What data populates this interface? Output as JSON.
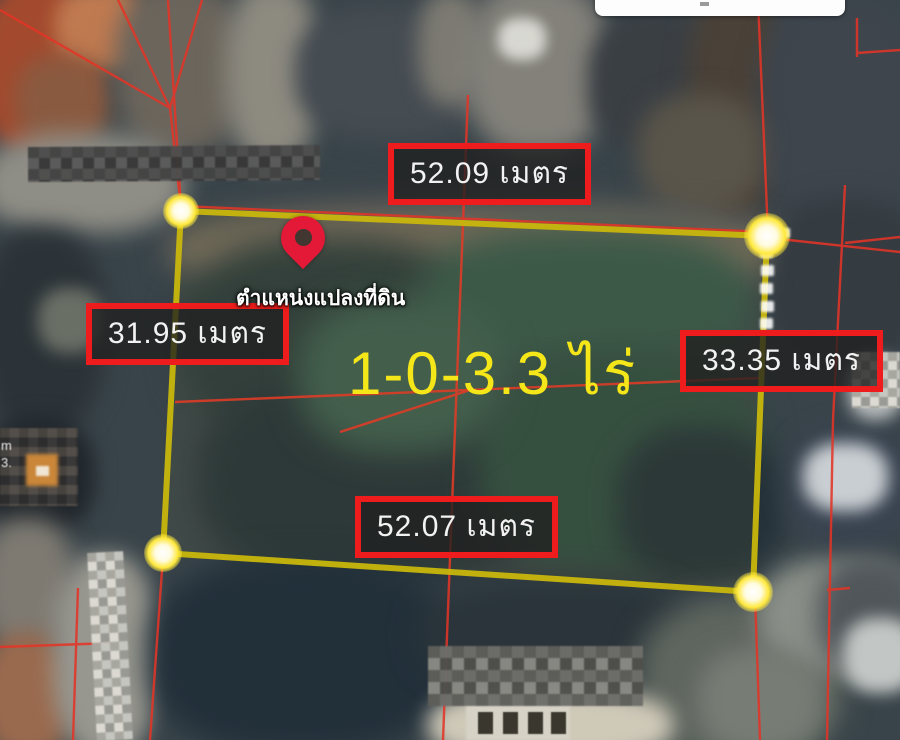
{
  "measurements": {
    "top": "52.09 เมตร",
    "left": "31.95 เมตร",
    "right": "33.35 เมตร",
    "bottom": "52.07 เมตร"
  },
  "area_label": "1-0-3.3 ไร่",
  "pin_caption": "ตำแหน่งแปลงที่ดิน",
  "blurred_fragments": {
    "left_top": "m",
    "left_bottom": "3."
  },
  "colors": {
    "measure-border": "#ee1c1c",
    "measure-bg": "rgba(32,32,32,0.78)",
    "measure-text": "#f2f2f2",
    "plot-outline": "#c9b70c",
    "vertex-glow": "#ffe93d",
    "area-text": "#f4e618",
    "parcel-line": "#e23427",
    "pin-red": "#e31937"
  }
}
